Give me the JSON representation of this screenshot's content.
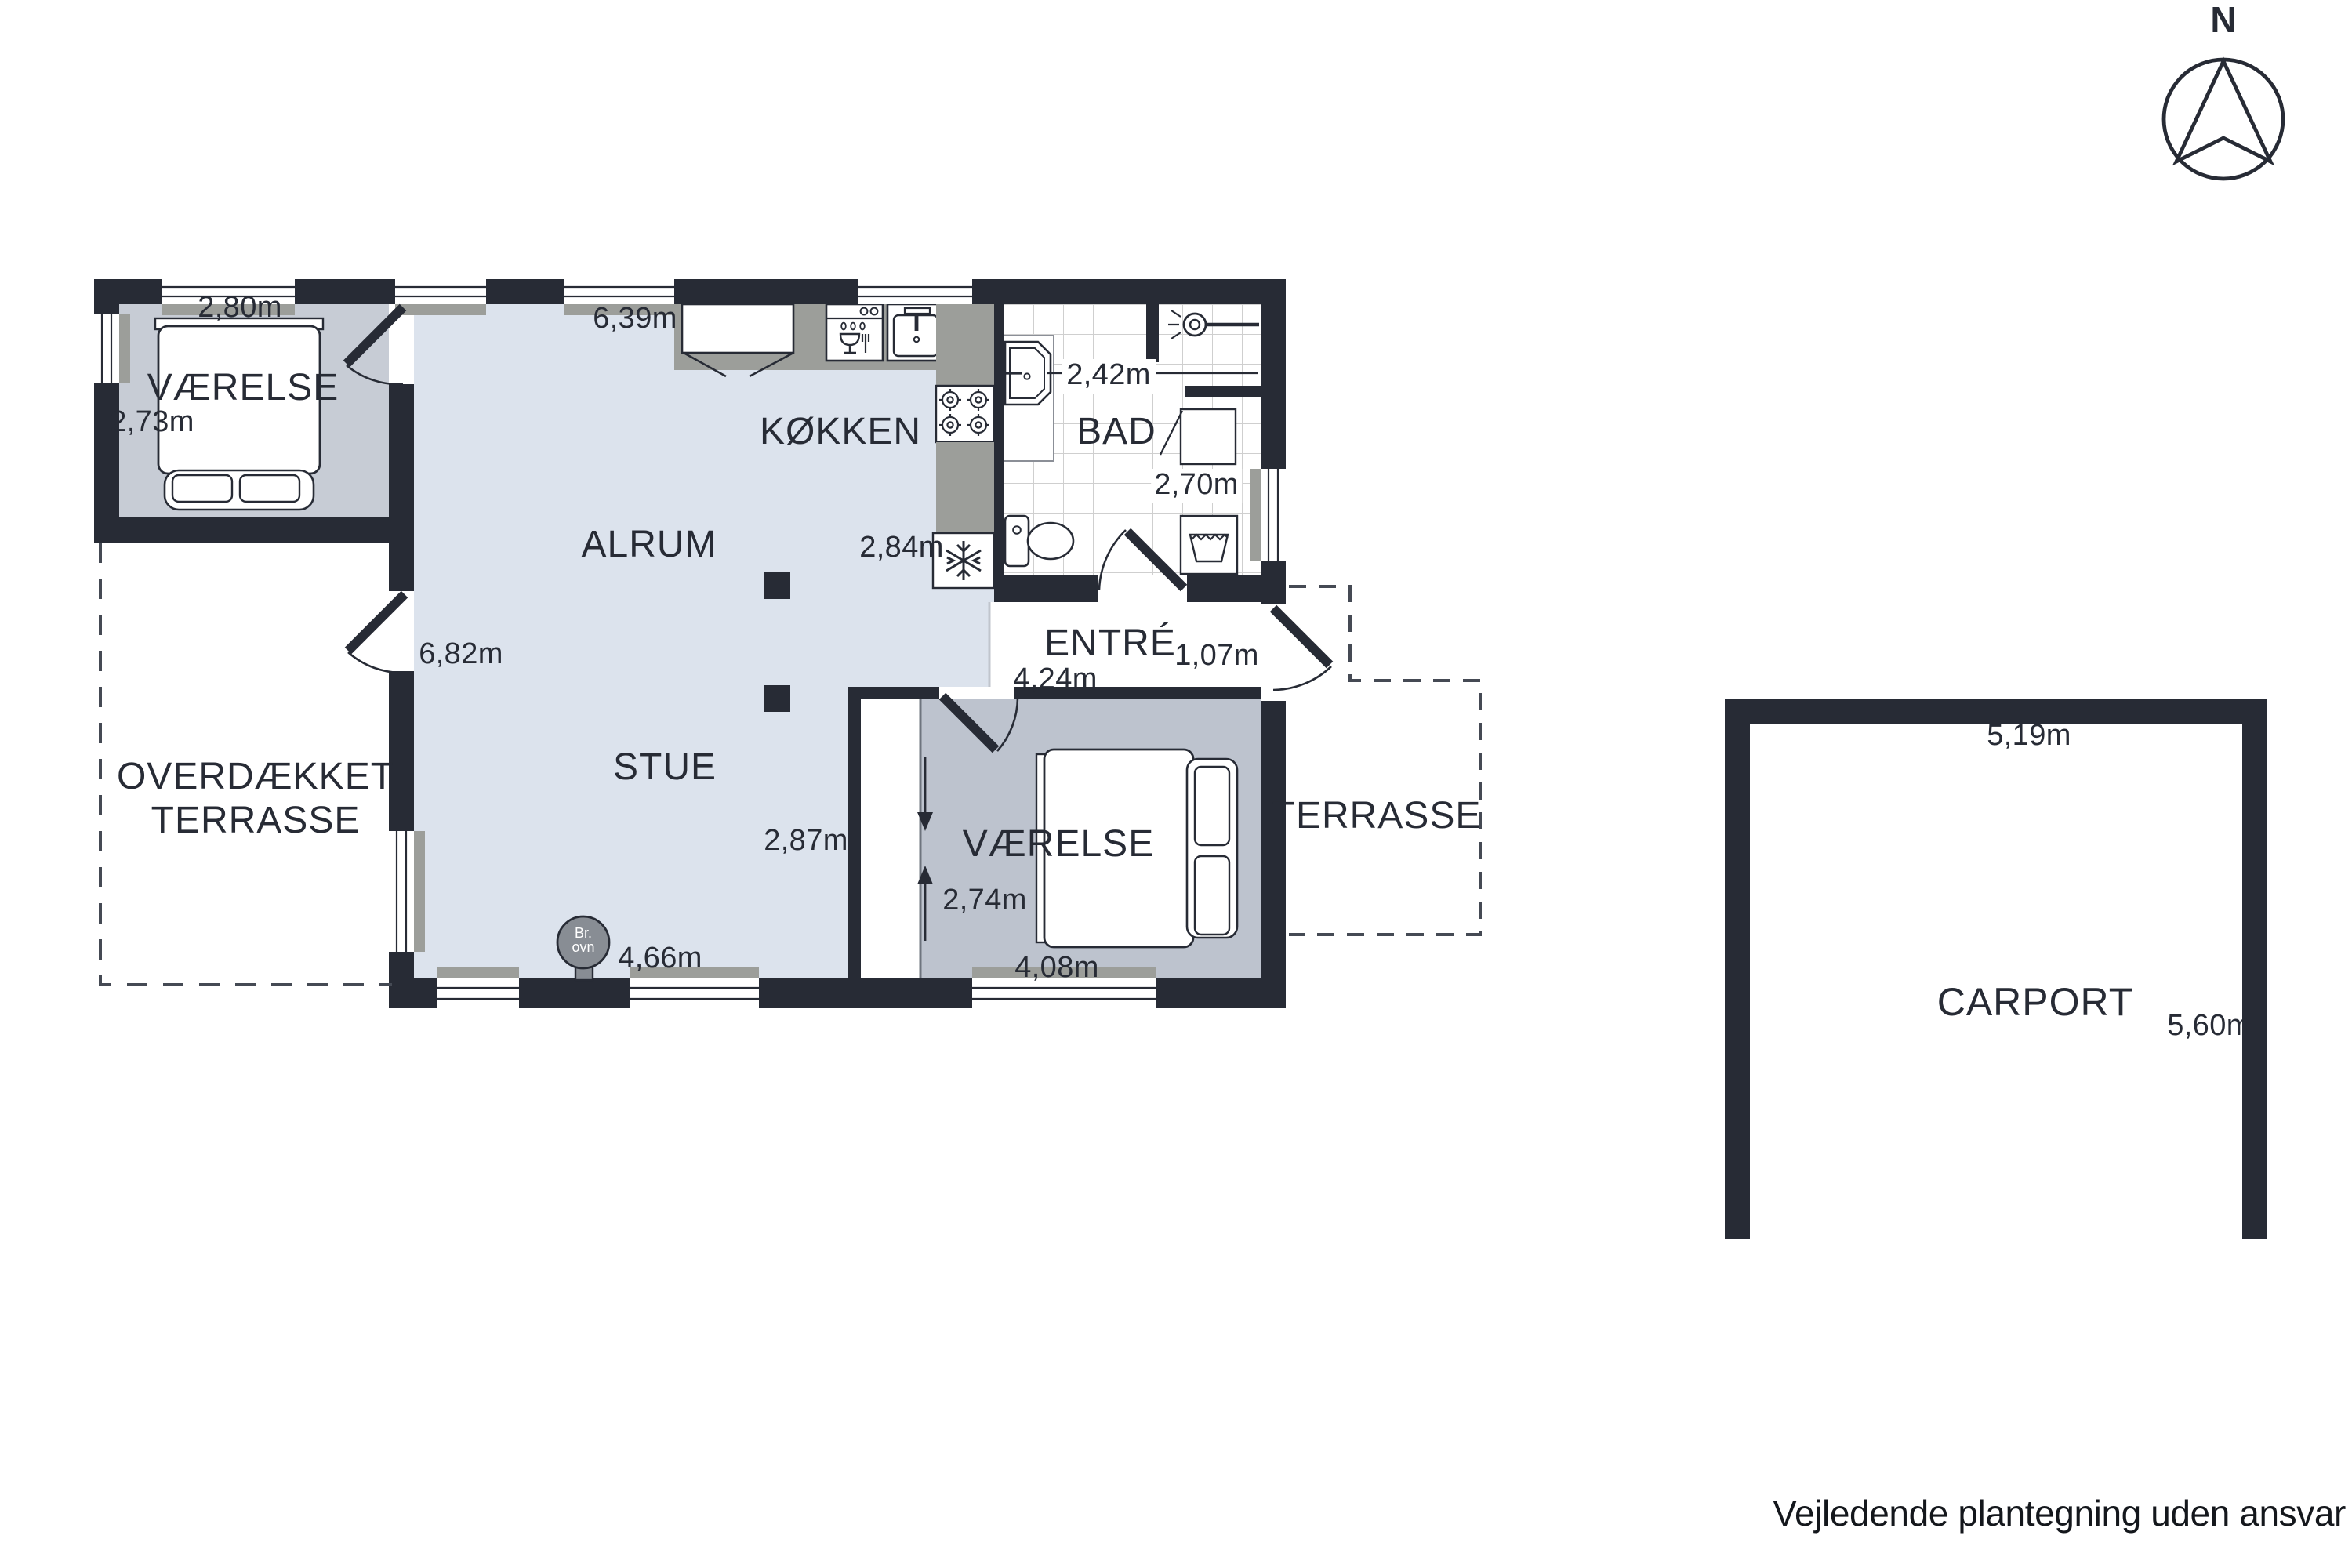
{
  "compass": {
    "label": "N"
  },
  "footer": "Vejledende plantegning uden ansvar",
  "house": {
    "bedroom_left": {
      "label": "VÆRELSE",
      "width": "2,80m",
      "depth": "2,73m"
    },
    "alrum": {
      "label": "ALRUM",
      "width": "6,39m",
      "length": "6,82m"
    },
    "kitchen": {
      "label": "KØKKEN",
      "depth": "2,84m"
    },
    "bath": {
      "label": "BAD",
      "width": "2,42m",
      "depth": "2,70m"
    },
    "entre": {
      "label": "ENTRÉ",
      "door_width": "1,07m",
      "width": "4,24m"
    },
    "stue": {
      "label": "STUE",
      "depth": "2,87m",
      "width": "4,66m"
    },
    "bedroom_right": {
      "label": "VÆRELSE",
      "depth": "2,74m",
      "width": "4,08m"
    },
    "covered_terrace": {
      "line1": "OVERDÆKKET",
      "line2": "TERRASSE"
    },
    "terrace": {
      "label": "TERRASSE"
    },
    "wood_stove": {
      "line1": "Br.",
      "line2": "ovn"
    }
  },
  "carport": {
    "label": "CARPORT",
    "width": "5,19m",
    "depth": "5,60m"
  },
  "colors": {
    "wall": "#272b35",
    "floor_light": "#dce3ed",
    "floor_grey_left": "#c7ccd5",
    "floor_grey_right": "#bdc3ce",
    "counter_grey": "#9c9e9a",
    "stove_grey": "#888d94"
  }
}
